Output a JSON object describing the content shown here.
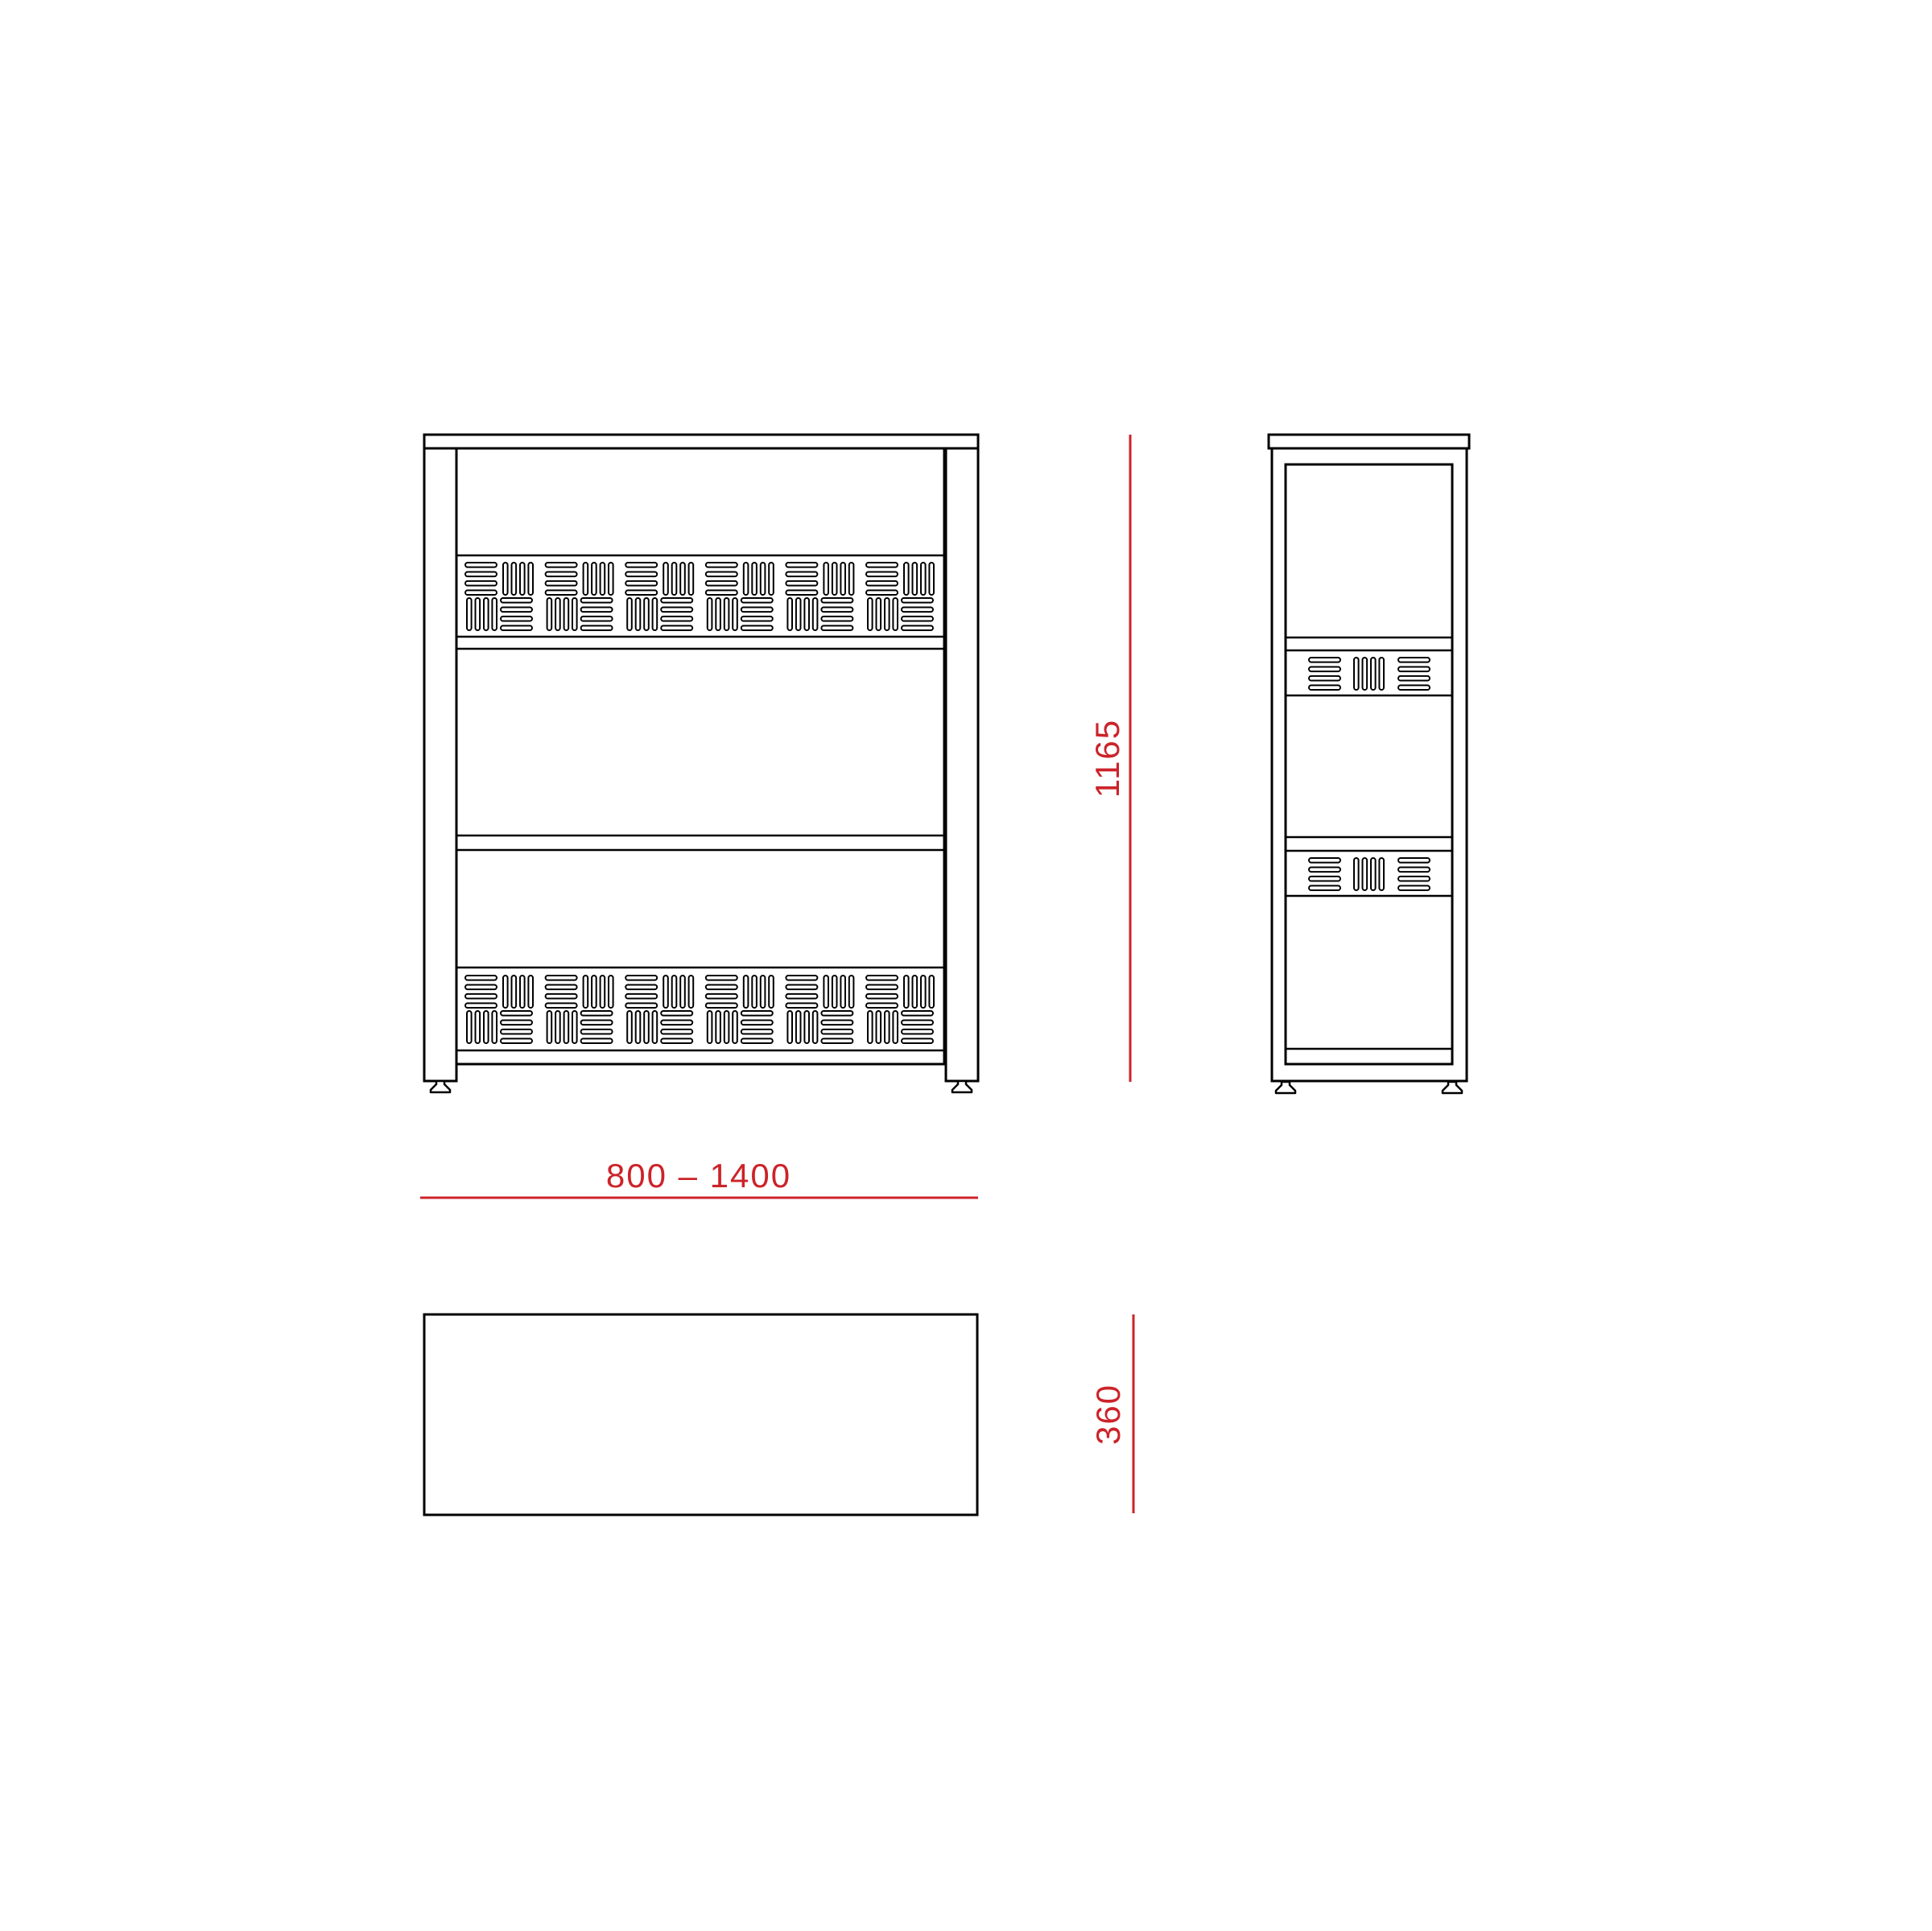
{
  "dimensions": {
    "height": "1165",
    "width_range": "800 – 1400",
    "depth": "360"
  },
  "colors": {
    "dimension_red": "#cc2329",
    "outline_black": "#000000",
    "background": "#ffffff"
  }
}
